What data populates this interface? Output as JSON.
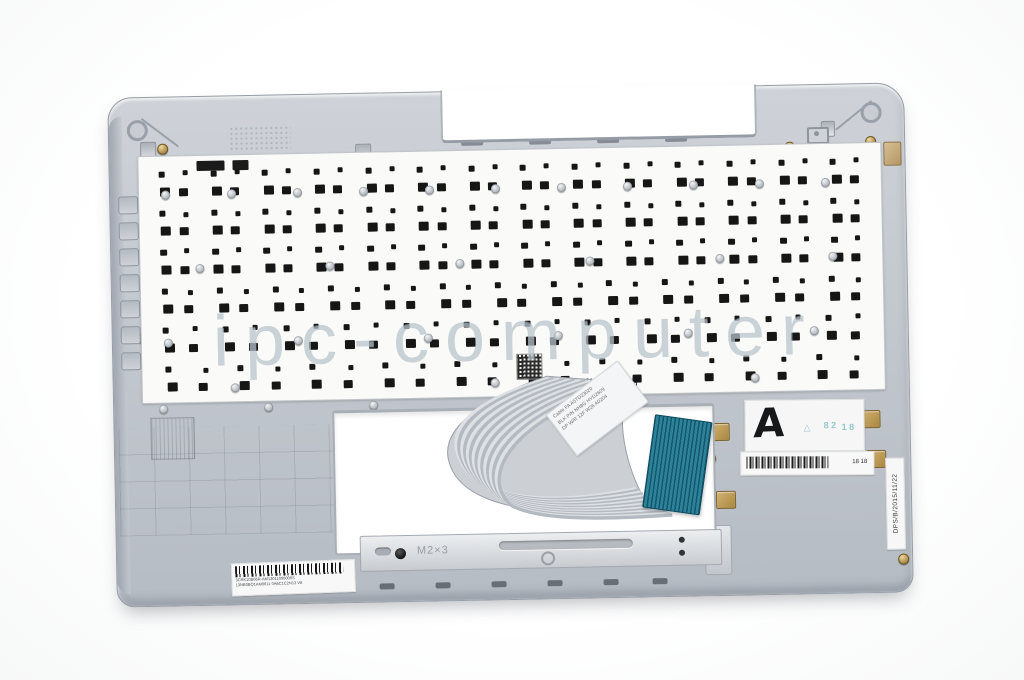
{
  "photo": {
    "watermark": "ipc-computer",
    "markings": {
      "bracket_screw_label": "M2×3",
      "grade_sticker_letter": "A",
      "date_code_sticker": "DPS/B/2015/11/22",
      "bottom_label_line1": "3CRK10B06R-AM13011090000S",
      "bottom_label_line2": "13NB0BQ1AM0611 0A6C1C2N13 V8",
      "cable_label_line1": "Cable FA A5TD23020",
      "cable_label_line2": "BLK P/N NH8G HYD2609",
      "cable_label_line3": "DP W/R 12F W26 A0204",
      "right_label_text": "18 18"
    },
    "stamps": {
      "stamp1": "△",
      "stamp2": "8 2",
      "stamp3": "1 8"
    },
    "colors": {
      "case_gray": "#c3c8cf",
      "membrane_white": "#fafaf8",
      "key_cutout_black": "#161616",
      "cable_connector_teal": "#2a7a91",
      "brass_gold": "#b3934f",
      "watermark_gray": "#98aab7"
    },
    "keyboard": {
      "rows": [
        14,
        14,
        14,
        13,
        12,
        10
      ]
    }
  }
}
